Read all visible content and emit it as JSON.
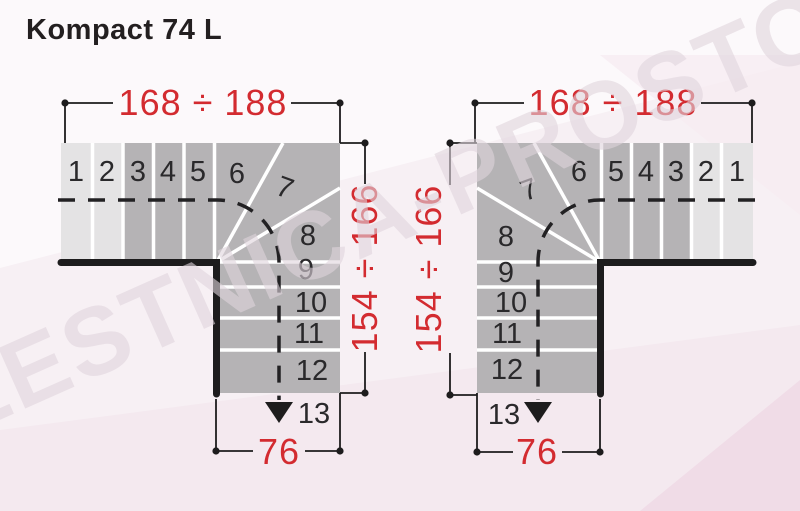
{
  "title": "Kompact 74 L",
  "watermark": "LESTNICA-PROSTO.RU",
  "colors": {
    "background": "#f7f0f4",
    "step_light": "#e4e3e4",
    "step_dark": "#b5b3b5",
    "wall_black": "#1d1c1d",
    "dimension_red": "#d32b30",
    "number_black": "#2a292b"
  },
  "dimensions": {
    "top_width": "168 ÷ 188",
    "side_height": "154 ÷ 166",
    "exit_width": "76"
  },
  "steps": [
    "1",
    "2",
    "3",
    "4",
    "5",
    "6",
    "7",
    "8",
    "9",
    "10",
    "11",
    "12",
    "13"
  ]
}
